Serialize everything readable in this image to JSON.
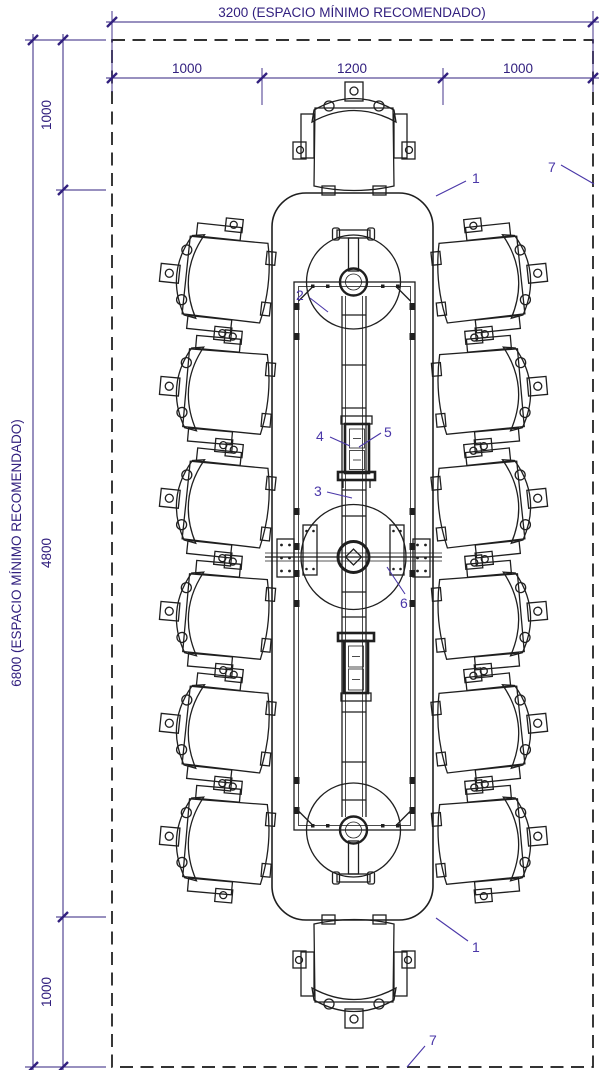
{
  "drawing_title": "Conference table plan view with 14 chairs and minimum recommended clearances",
  "colors": {
    "dimension_ink": "#32207f",
    "callout_ink": "#4a37a8",
    "drawing_ink": "#1f1f1f",
    "background": "#ffffff"
  },
  "dimensions": {
    "top_total": "3200 (ESPACIO MÍNIMO RECOMENDADO)",
    "top_segments": [
      "1000",
      "1200",
      "1000"
    ],
    "left_total": "6800 (ESPACIO MÍNIMO RECOMENDADO)",
    "left_segments": [
      "1000",
      "4800",
      "1000"
    ]
  },
  "callouts": {
    "table_top_upper": "1",
    "table_top_lower": "1",
    "boundary_upper": "7",
    "boundary_lower": "7",
    "frame": "2",
    "cable_tray": "3",
    "power_module": "4",
    "power_module_lid": "5",
    "beam_bracket": "6"
  }
}
